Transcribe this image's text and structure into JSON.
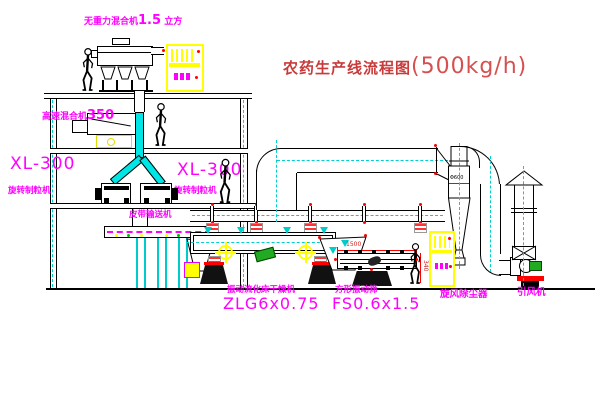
{
  "title": {
    "text": "农药生产线流程图",
    "capacity": "(500kg/h)"
  },
  "equipment_labels": {
    "gravity_mixer": {
      "prefix": "无重力混合机",
      "value": "1.5",
      "suffix": "立方"
    },
    "high_speed_mixer": {
      "prefix": "高速混合机",
      "value": "350"
    },
    "granulator_left": {
      "model": "XL-300",
      "name": "旋转制粒机"
    },
    "granulator_right": {
      "model": "XL-300",
      "name": "旋转制粒机"
    },
    "belt_conveyor": "皮带输送机",
    "fluid_bed_dryer": {
      "name": "振动流化床干燥机",
      "model": "ZLG6x0.75"
    },
    "vibrating_screen": {
      "name": "方形振动筛",
      "model": "FS0.6x1.5"
    },
    "cyclone": "旋风除尘器",
    "induced_draft_fan": "引风机"
  },
  "dimensions": {
    "screen_length": "1500",
    "screen_height": "340",
    "cyclone_diameter": "Φ600"
  },
  "colors": {
    "label_magenta": "#ff00ff",
    "title_red": "#c93a3a",
    "line_black": "#000000",
    "centerline_cyan": "#00cfcf",
    "accent_yellow": "#ffff00",
    "accent_red": "#ff0000",
    "motor_green": "#22aa22"
  }
}
